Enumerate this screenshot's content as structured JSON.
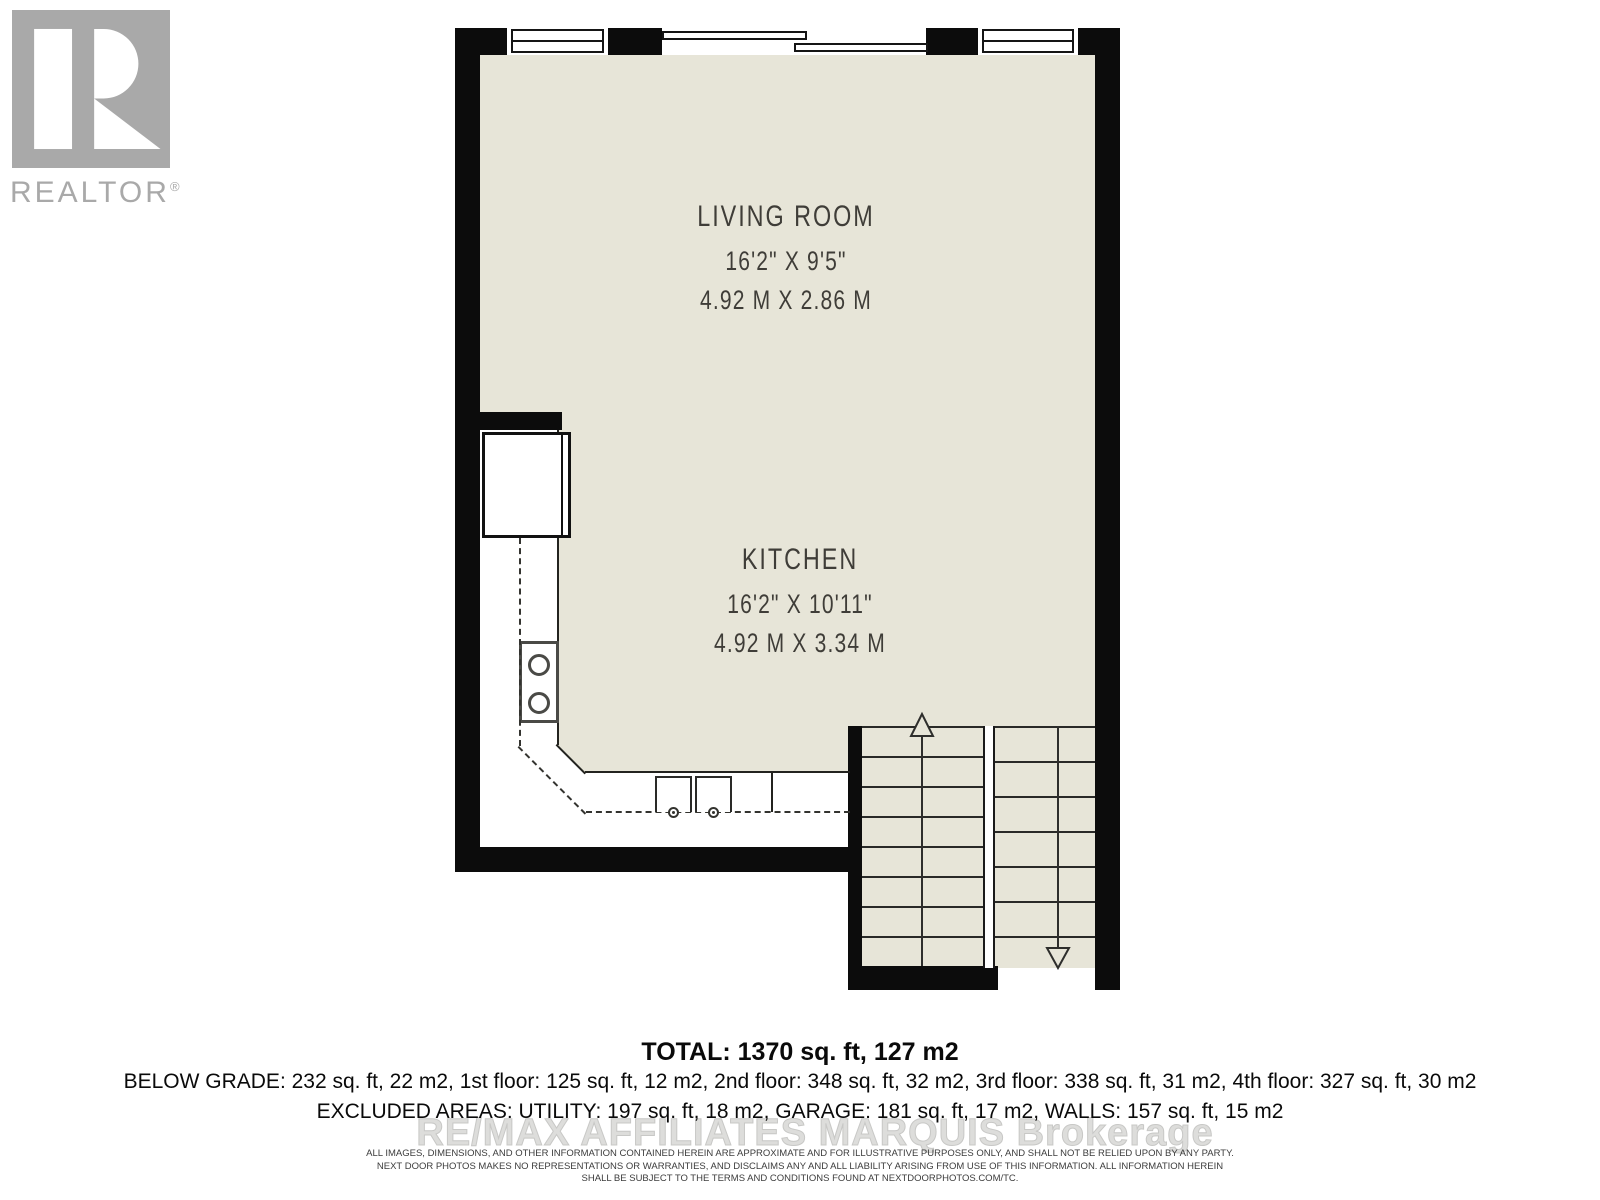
{
  "logo": {
    "text": "REALTOR",
    "mark": "®"
  },
  "rooms": [
    {
      "name": "LIVING ROOM",
      "imperial": "16'2\" X 9'5\"",
      "metric": "4.92 M X 2.86 M"
    },
    {
      "name": "KITCHEN",
      "imperial": "16'2\" X 10'11\"",
      "metric": "4.92 M X 3.34 M"
    }
  ],
  "summary": {
    "total": "TOTAL: 1370 sq. ft, 127 m2",
    "floors": "BELOW GRADE: 232 sq. ft, 22 m2, 1st floor: 125 sq. ft, 12 m2, 2nd floor: 348 sq. ft, 32 m2, 3rd floor: 338 sq. ft, 31 m2, 4th floor: 327 sq. ft, 30 m2",
    "excluded": "EXCLUDED AREAS: UTILITY: 197 sq. ft, 18 m2, GARAGE: 181 sq. ft, 17 m2, WALLS: 157 sq. ft, 15 m2"
  },
  "watermark": "RE/MAX AFFILIATES MARQUIS Brokerage",
  "disclaimer": {
    "line1": "ALL IMAGES, DIMENSIONS, AND OTHER INFORMATION CONTAINED HEREIN ARE APPROXIMATE AND FOR ILLUSTRATIVE PURPOSES ONLY, AND SHALL NOT BE RELIED UPON BY ANY PARTY.",
    "line2": "NEXT DOOR PHOTOS MAKES NO REPRESENTATIONS OR WARRANTIES, AND DISCLAIMS ANY AND ALL LIABILITY ARISING FROM USE OF THIS INFORMATION. ALL INFORMATION HEREIN",
    "line3": "SHALL BE SUBJECT TO THE TERMS AND CONDITIONS FOUND AT NEXTDOORPHOTOS.COM/TC."
  },
  "colors": {
    "floor": "#e7e5d8",
    "wall": "#0c0c0c",
    "logo_gray": "#a9a9a9",
    "label_text": "#3f3d38",
    "watermark_gray": "#dddddb"
  }
}
